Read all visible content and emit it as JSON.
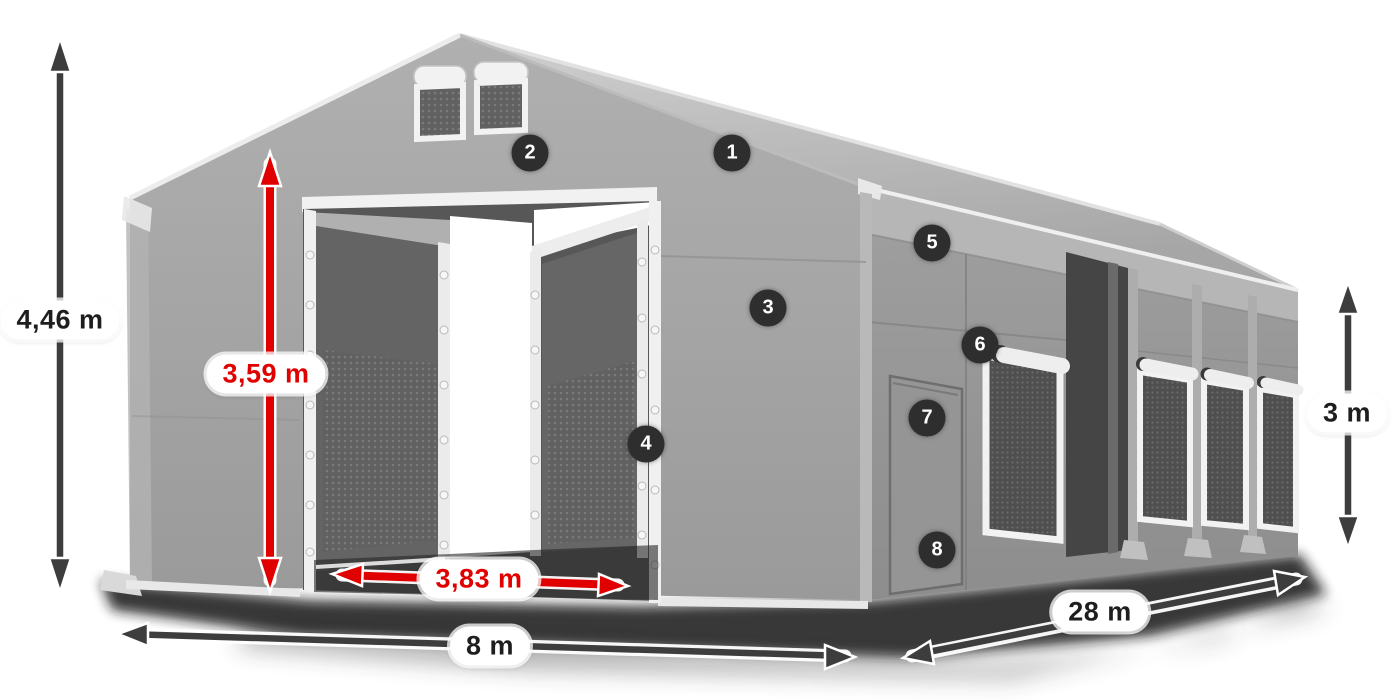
{
  "dimensions": {
    "total_height": "4,46 m",
    "entrance_height": "3,59 m",
    "entrance_width": "3,83 m",
    "width": "8 m",
    "length": "28 m",
    "side_height": "3 m"
  },
  "markers": [
    "1",
    "2",
    "3",
    "4",
    "5",
    "6",
    "7",
    "8"
  ],
  "colors": {
    "dimension_arrow_dark": "#3d3d3d",
    "dimension_arrow_red": "#e00000",
    "marker_background": "#2e2e2e",
    "marker_text": "#ffffff",
    "label_pill_background": "#ffffff",
    "tent_gray": "#a0a0a0",
    "background": "#ffffff"
  }
}
